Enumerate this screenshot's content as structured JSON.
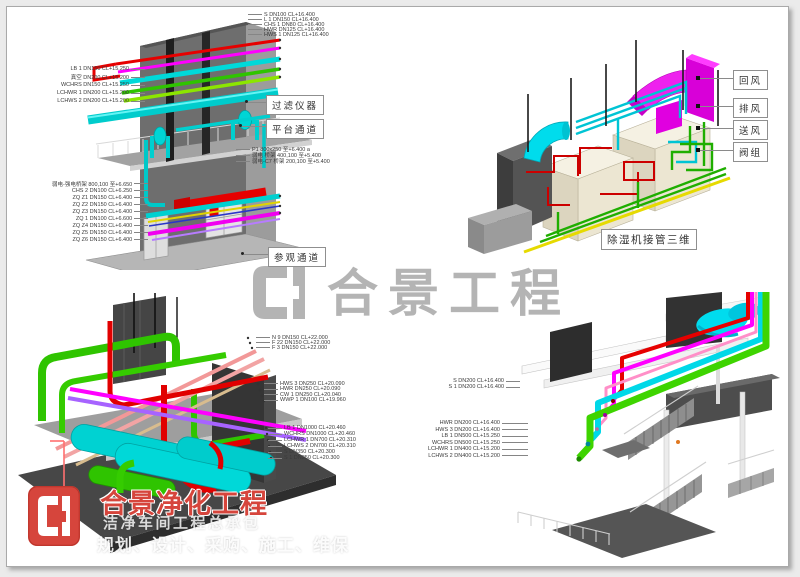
{
  "watermark": {
    "logo": "heju-monogram",
    "text": "合景工程"
  },
  "brand": {
    "title": "合景净化工程",
    "subtitle": "洁净车间工程总承包",
    "services": "规划、设计、采购、施工、维保"
  },
  "views": {
    "top_left": {
      "labels_top_right": [
        "S DN100 CL+16.400",
        "L 1 DN150 CL+16.400",
        "CHS 1 DN80 CL+16.400",
        "HWR DN125 CL+16.400",
        "HWS 1 DN125 CL+16.400"
      ],
      "labels_left_upper": [
        "LB 1 DN150 CL+15.250",
        "真空 DN200 CL+15.200",
        "WCHRS DN150 CL+15.250",
        "LCHWR 1 DN200 CL+15.200",
        "LCHWS 2 DN200 CL+15.200"
      ],
      "labels_mid_right": [
        "P1 800x250 至+6.400 a",
        "弱电 桥架 400,100 至+5.400",
        "弱电-C7 桥架 200,100 至+5.400"
      ],
      "labels_left_lower": [
        "弱电-强电桥架 800,100 至+6.650",
        "CHS 2 DN100 CL+6.250",
        "ZQ Z1 DN150 CL+6.400",
        "ZQ Z2 DN150 CL+6.400",
        "ZQ Z3 DN150 CL+6.400",
        "ZQ 1 DN100 CL+6.600",
        "ZQ Z4 DN150 CL+6.400",
        "ZQ Z5 DN150 CL+6.400",
        "ZQ Z6 DN150 CL+6.400"
      ],
      "callout_filter": "过滤仪器",
      "callout_platform": "平台通道",
      "callout_visit": "参观通道"
    },
    "top_right": {
      "callouts": [
        "回风",
        "排风",
        "送风",
        "阀组"
      ],
      "caption": "除湿机接管三维"
    },
    "bottom_left": {
      "labels_g1": [
        "N 9 DN150 CL+22.000",
        "F 22 DN150 CL+22.000",
        "F 3 DN150 CL+22.000"
      ],
      "labels_g2": [
        "HWS 3 DN250 CL+20.090",
        "HWR DN250 CL+20.090",
        "CW 1 DN250 CL+20.040",
        "WWP 1 DN100 CL+19.960"
      ],
      "labels_g3": [
        "LB 1 DN1000 CL+20.460",
        "WCHRS DN1000 CL+20.460",
        "LCHWR 1 DN700 CL+20.310",
        "LCHWS 2 DN700 CL+20.310",
        "S DN350 CL+20.300",
        "S 1 DN250 CL+20.300"
      ]
    },
    "bottom_right": {
      "labels_g1": [
        "S DN200 CL+16.400",
        "S 1 DN200 CL+16.400"
      ],
      "labels_g2": [
        "HWR DN200 CL+16.400",
        "HWS 3 DN200 CL+16.400",
        "LB 1 DN500 CL+15.250",
        "WCHRS DN500 CL+15.250",
        "LCHWR 1 DN400 CL+15.200",
        "LCHWS 2 DN400 CL+15.200"
      ]
    }
  },
  "colors": {
    "pipe_red": "#e60000",
    "pipe_magenta": "#ff00ff",
    "pipe_cyan": "#00d5d5",
    "pipe_green": "#2fc400",
    "pipe_yellow": "#e6da00",
    "pipe_pink": "#f29898",
    "pipe_violet": "#a763ff",
    "duct_magenta": "#ee22ee",
    "duct_cyan": "#00dcec",
    "equipment_beige": "#ece6d2",
    "structure_gray": "#6e6e6e",
    "watermark_gray": "#b4b4b4",
    "logo_red": "#d6453c"
  }
}
